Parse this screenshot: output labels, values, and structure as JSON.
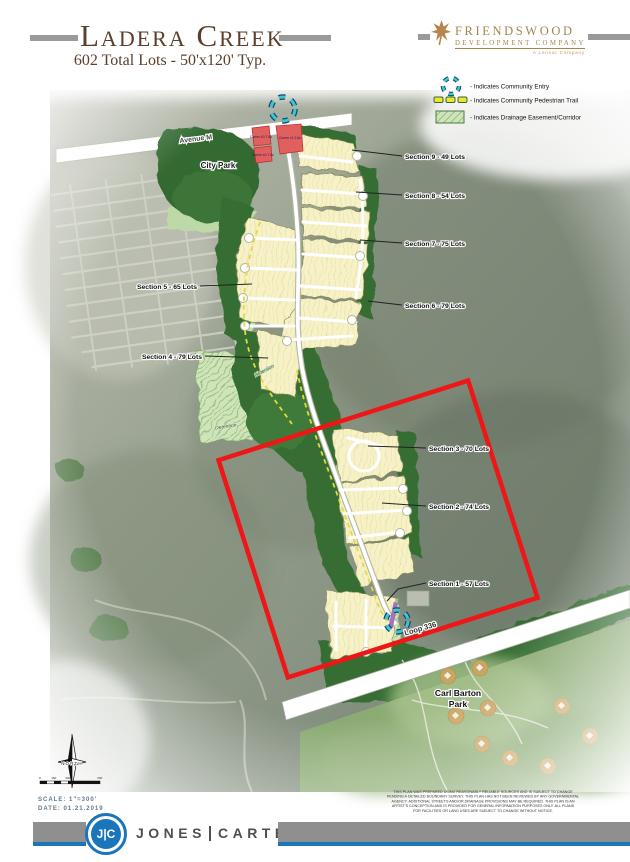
{
  "header": {
    "title": "Ladera Creek",
    "subtitle": "602 Total Lots - 50'x120' Typ.",
    "logo": {
      "line1": "FRIENDSWOOD",
      "line2": "DEVELOPMENT COMPANY",
      "line3": "A Lennar Company"
    }
  },
  "legend": {
    "items": [
      {
        "icon": "community-entry-icon",
        "label": "- Indicates Community Entry"
      },
      {
        "icon": "pedestrian-trail-icon",
        "label": "- Indicates Community Pedestrian Trail"
      },
      {
        "icon": "drainage-easement-icon",
        "label": "- Indicates Drainage Easement/Corridor"
      }
    ]
  },
  "map": {
    "sections": [
      {
        "label": "Section 9 - 49 Lots"
      },
      {
        "label": "Section 8 - 54 Lots"
      },
      {
        "label": "Section 7 - 75 Lots"
      },
      {
        "label": "Section 5 - 65 Lots"
      },
      {
        "label": "Section 6 - 79 Lots"
      },
      {
        "label": "Section 4 - 79 Lots"
      },
      {
        "label": "Section 3 - 70 Lots"
      },
      {
        "label": "Section 2 - 74 Lots"
      },
      {
        "label": "Section 1 - 57 Lots"
      }
    ],
    "roads": {
      "avenue": "Avenue M",
      "loop": "Loop 336"
    },
    "places": {
      "city_park": "City Park",
      "carl_barton_line1": "Carl Barton",
      "carl_barton_line2": "Park",
      "detention": "Detention"
    },
    "commercial": [
      "Comm ±0.7 Ac",
      "Comm ±0.7 Ac",
      "Comm ±1.3 Ac"
    ],
    "north_label": "NORTH",
    "scale_ticks": [
      "0'",
      "150'",
      "300'",
      "600'"
    ],
    "scale_text": "SCALE:  1\"=300'",
    "date_text": "DATE: 01.21.2019"
  },
  "disclaimer": {
    "lines": [
      "THIS PLAN WAS PREPARED USING REASONABLY RELIABLE SOURCES AND IS SUBJECT TO CHANGE",
      "PENDING A DETAILED BOUNDARY SURVEY.  THIS PLAN HAS NOT BEEN REVIEWED BY ANY GOVERNMENTAL",
      "AGENCY.  ADDITIONAL STREETS AND/OR DRAINAGE PROVISIONS MAY BE REQUIRED.  THIS PLAN IS AN",
      "ARTIST'S CONCEPTION AND IS PROVIDED FOR GENERAL INFORMATION PURPOSES ONLY.  ALL PLANS",
      "FOR FACILITIES OR LAND USES ARE SUBJECT TO CHANGE WITHOUT NOTICE."
    ]
  },
  "footer": {
    "monogram": "J|C",
    "name_left": "JONES",
    "name_right": "CARTER"
  },
  "colors": {
    "title_brown": "#5d3d2b",
    "logo_gold": "#a3854e",
    "boundary_red": "#ee1616",
    "entry_teal": "#3cc7d0",
    "trail_yellow": "#e8d83c",
    "footer_blue": "#1b75bb"
  }
}
